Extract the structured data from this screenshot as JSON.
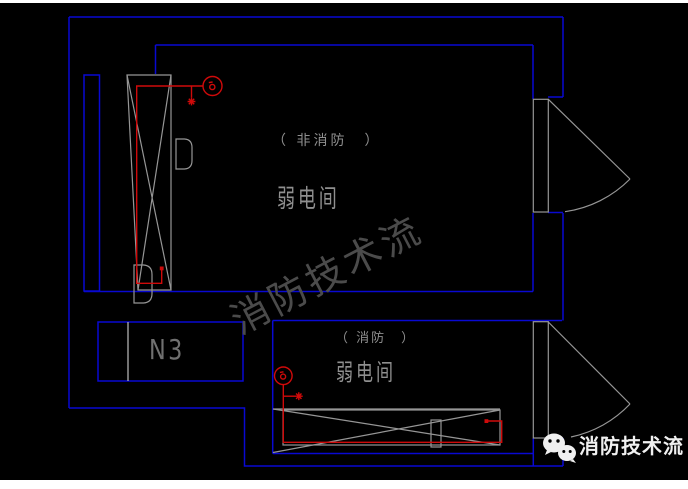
{
  "drawing": {
    "room_top": {
      "type_label": "（ 非消防　）",
      "name_label": "弱电间"
    },
    "room_bottom": {
      "type_label": "（ 消防　）",
      "name_label": "弱电间"
    },
    "panel_label": "N3",
    "watermark_text": "消防技术流",
    "logo": {
      "text": "消防技术流"
    }
  },
  "colors": {
    "background": "#000000",
    "page_white": "#ffffff",
    "wall_blue": "#0909d2",
    "line_gray": "#969696",
    "line_light": "#bdbdbd",
    "wire_red": "#cf0a0a",
    "text_gray": "#8f8f8f",
    "panel_gray": "#707070",
    "watermark_gray": "#4b4b4b",
    "logo_white": "#f0f0f0"
  }
}
